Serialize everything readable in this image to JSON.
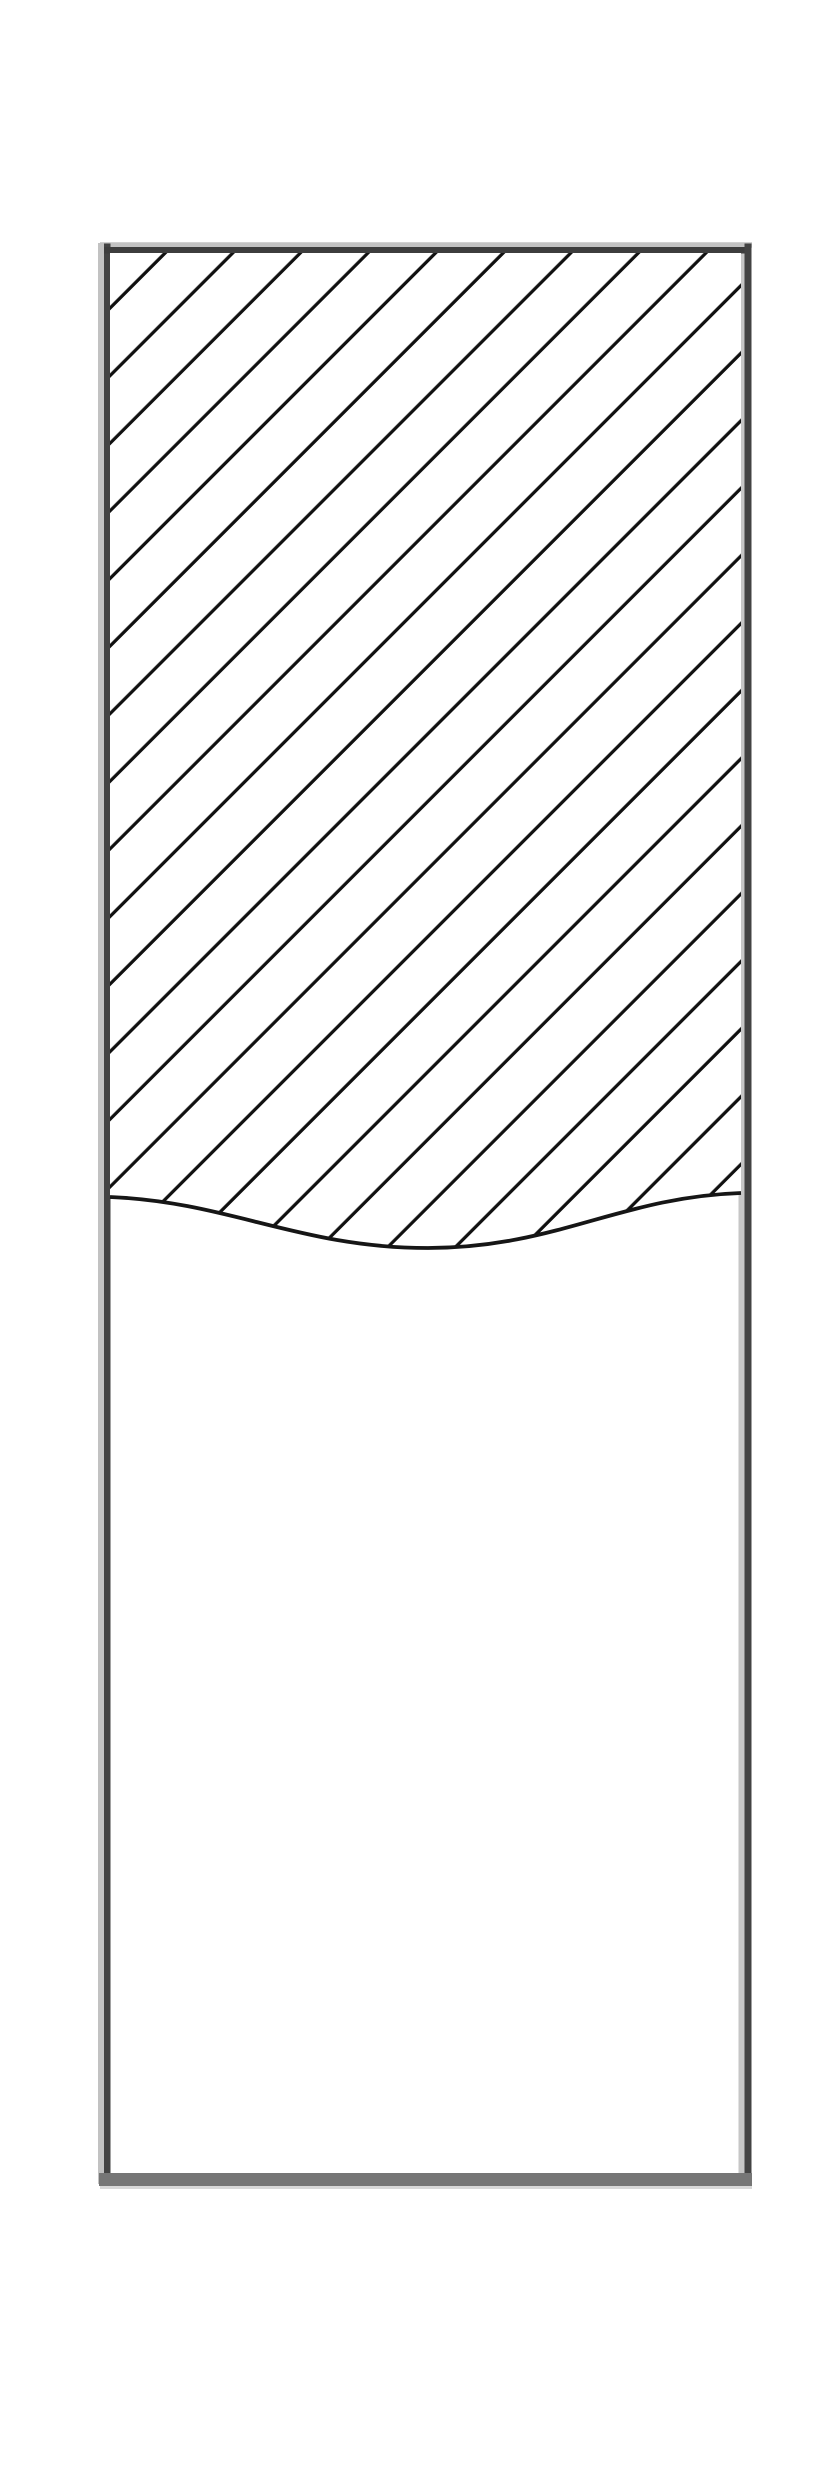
{
  "figure": {
    "kind": "technical-section-drawing",
    "width": 830,
    "height": 2491,
    "background": "#ffffff"
  },
  "drawing": {
    "viewbox": "0 0 830 2491",
    "border": {
      "halo_lines": [
        {
          "name": "halo-left",
          "x1": 101,
          "y1": 243,
          "x2": 101,
          "y2": 2184,
          "stroke": "#c2c2c2",
          "width": 6
        },
        {
          "name": "halo-top",
          "x1": 100,
          "y1": 245,
          "x2": 752,
          "y2": 245,
          "stroke": "#c2c2c2",
          "width": 5.5
        },
        {
          "name": "halo-right-inner",
          "x1": 741.5,
          "y1": 247,
          "x2": 741.5,
          "y2": 2173,
          "stroke": "#c6c6c6",
          "width": 6
        },
        {
          "name": "halo-bottom",
          "x1": 100,
          "y1": 2187.5,
          "x2": 752,
          "y2": 2187.5,
          "stroke": "#d8d8d8",
          "width": 3
        }
      ],
      "edges": [
        {
          "name": "edge-left",
          "x1": 107.25,
          "y1": 243.5,
          "x2": 107.25,
          "y2": 2184,
          "stroke": "#434343",
          "width": 6.5
        },
        {
          "name": "edge-top",
          "x1": 104,
          "y1": 250.25,
          "x2": 751.5,
          "y2": 250.25,
          "stroke": "#3d3d3d",
          "width": 6.5
        },
        {
          "name": "edge-right",
          "x1": 748,
          "y1": 243.5,
          "x2": 748,
          "y2": 2184,
          "stroke": "#434343",
          "width": 7
        },
        {
          "name": "edge-bottom",
          "x1": 99,
          "y1": 2179.5,
          "x2": 752,
          "y2": 2179.5,
          "stroke": "#767676",
          "width": 13
        }
      ]
    },
    "hatch": {
      "tile_size": 47.8,
      "angle_deg": -45,
      "line_offset": 8.8,
      "stroke": "#101010",
      "stroke_width": 3.2
    },
    "section": {
      "outline_path": "M110,253 L741,253 L741,1193 C620,1197 556,1248 428,1248 C300,1248 230,1202 110,1197 Z",
      "fill": "#ffffff"
    },
    "break_line": {
      "path": "M110,1197 C230,1202 300,1248 428,1248 C556,1248 620,1197 741,1193",
      "stroke": "#161616",
      "stroke_width": 3.8,
      "fill": "none"
    }
  }
}
